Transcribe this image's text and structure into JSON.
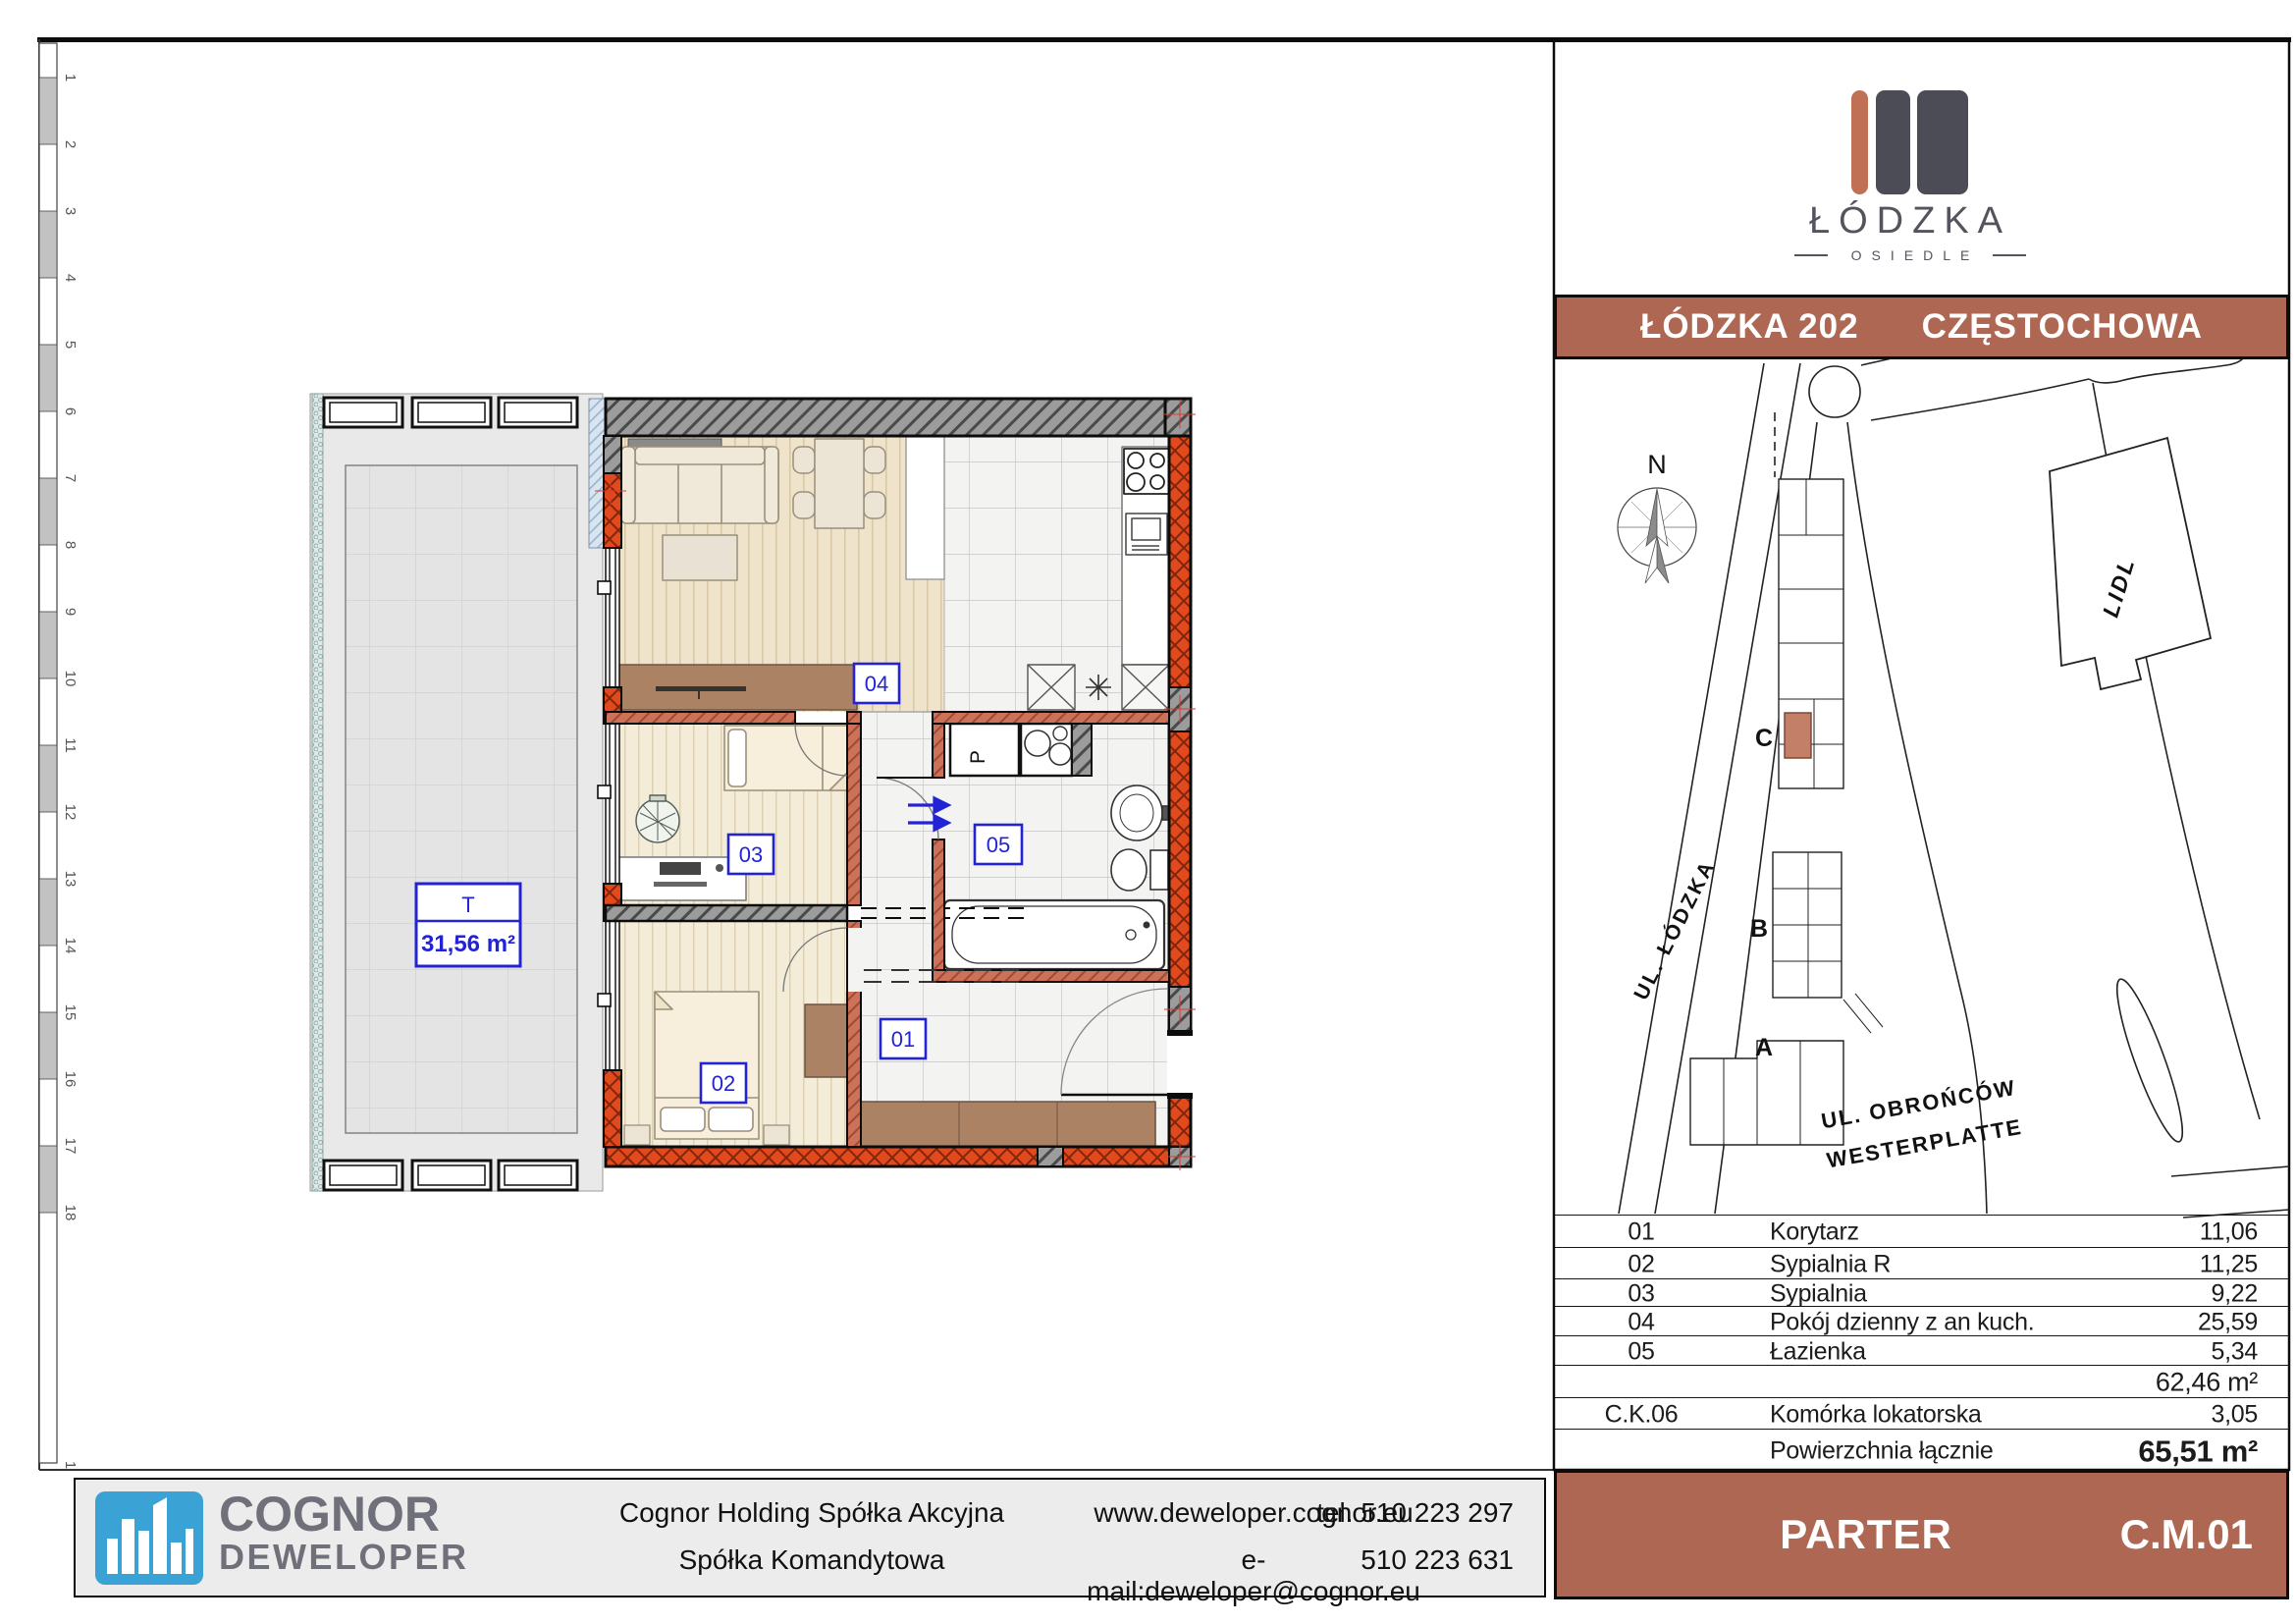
{
  "colors": {
    "accent_terracotta": "#ad6752",
    "wall_orange": "#e2491c",
    "wall_salmon": "#cd7158",
    "wall_gray": "#9c9c9c",
    "label_blue": "#2323d6",
    "logo_blue": "#3aa2d4"
  },
  "ruler": {
    "labels": [
      "1",
      "2",
      "3",
      "4",
      "5",
      "6",
      "7",
      "8",
      "9",
      "10",
      "11",
      "12",
      "13",
      "14",
      "15",
      "16",
      "17",
      "18"
    ],
    "bottom_label": "1"
  },
  "plan": {
    "terrace": {
      "code": "T",
      "area": "31,56 m²"
    },
    "room_labels": {
      "r01": "01",
      "r02": "02",
      "r03": "03",
      "r04": "04",
      "r05": "05"
    },
    "washer_label": "P"
  },
  "panel": {
    "logo": {
      "name": "ŁÓDZKA",
      "sub": "OSIEDLE"
    },
    "header": {
      "left": "ŁÓDZKA 202",
      "right": "CZĘSTOCHOWA"
    },
    "map": {
      "north": "N",
      "buildings": [
        "C",
        "B",
        "A"
      ],
      "store": "LIDL",
      "street1": "UL. ŁÓDZKA",
      "street2_line1": "UL. OBROŃCÓW",
      "street2_line2": "WESTERPLATTE"
    },
    "table": {
      "rows": [
        {
          "no": "01",
          "name": "Korytarz",
          "value": "11,06"
        },
        {
          "no": "02",
          "name": "Sypialnia R",
          "value": "11,25"
        },
        {
          "no": "03",
          "name": "Sypialnia",
          "value": "9,22"
        },
        {
          "no": "04",
          "name": "Pokój dzienny z an kuch.",
          "value": "25,59"
        },
        {
          "no": "05",
          "name": "Łazienka",
          "value": "5,34"
        },
        {
          "no": "",
          "name": "",
          "value": "62,46 m²"
        },
        {
          "no": "C.K.06",
          "name": "Komórka lokatorska",
          "value": "3,05"
        },
        {
          "no": "",
          "name": "Powierzchnia łącznie",
          "value": "65,51 m²"
        }
      ]
    },
    "floor": "PARTER",
    "unit": "C.M.01"
  },
  "footer": {
    "logo_line1": "COGNOR",
    "logo_line2": "DEWELOPER",
    "company_line1": "Cognor Holding Spółka Akcyjna",
    "company_line2": "Spółka Komandytowa",
    "web": "www.deweloper.cognor.eu",
    "email": "e-mail:deweloper@cognor.eu",
    "phone1": "tel. 510 223 297",
    "phone2": "510 223 631"
  }
}
